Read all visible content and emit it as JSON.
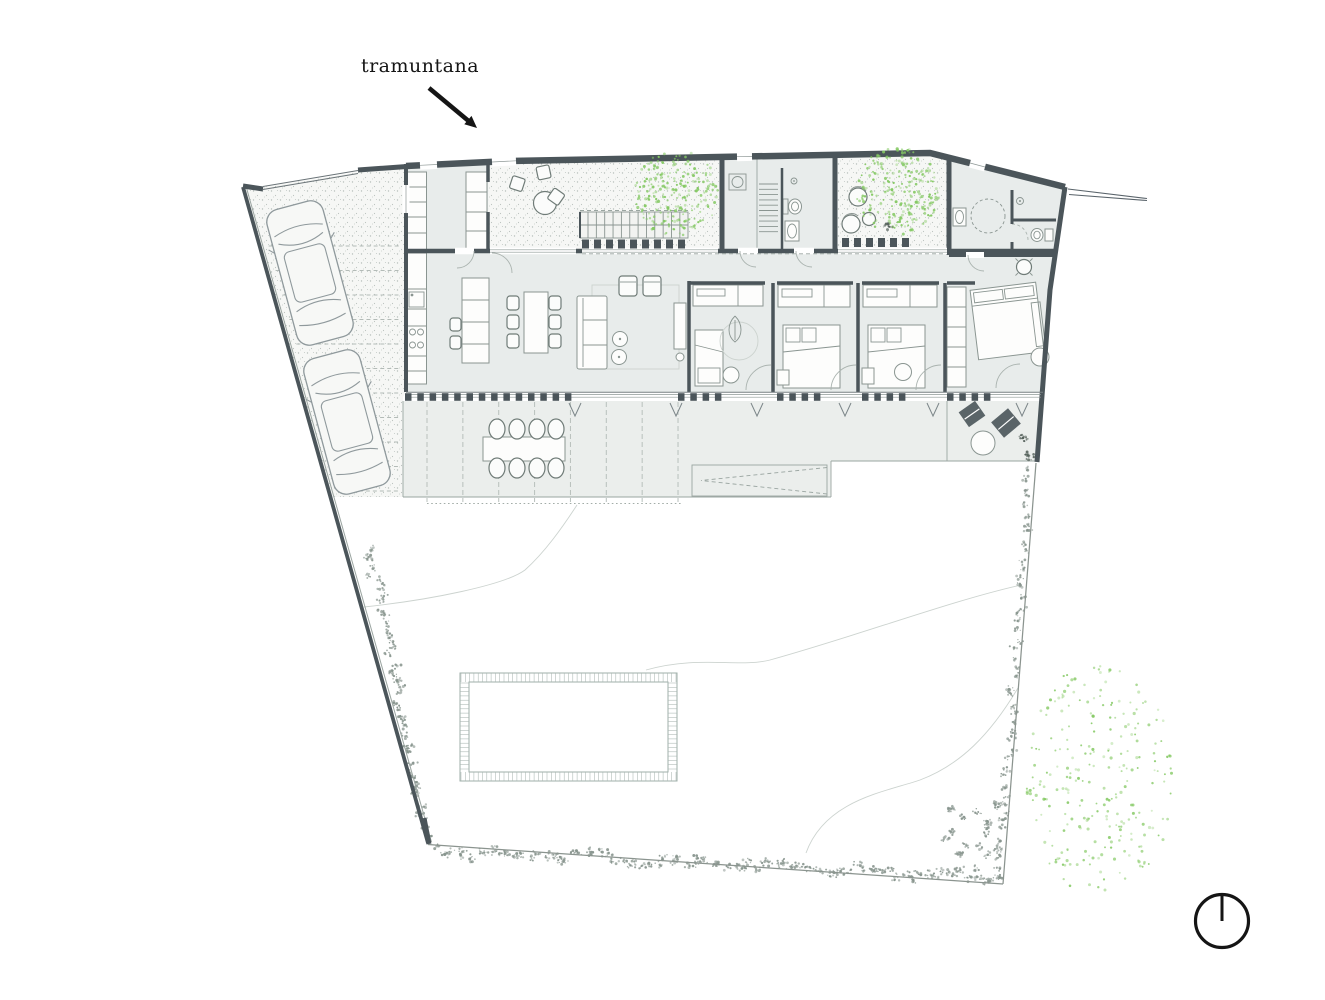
{
  "document": {
    "type": "architectural-site-plan",
    "content": "ground floor plan of a single-storey house with carport, courtyards, pergola terrace, garden and pool"
  },
  "labels": {
    "wind_annotation": "tramuntana"
  },
  "icons": {
    "wind_arrow": "arrow-pointing-southeast",
    "north_indicator": "circle-with-radius-line-to-top"
  },
  "colors": {
    "paper": "#ffffff",
    "ink": "#151515",
    "wall_dark": "#4b555a",
    "room_fill": "#e8eceb",
    "terrace_fill": "#ebeeec",
    "line_faint": "#ccd3cf",
    "vegetation_green": "#85c964",
    "shrub": "#87948d",
    "shrub_dark": "#55615b"
  },
  "plan": {
    "site": "irregular quadrilateral plot, wider at bottom",
    "rooms": [
      "carport",
      "entry-hall",
      "entry-courtyard",
      "stair-courtyard-with-tree",
      "kitchen",
      "dining-area",
      "living-area",
      "laundry-room",
      "bathroom",
      "tree-courtyard",
      "bedroom-1",
      "bedroom-2",
      "bedroom-3",
      "master-bedroom",
      "master-bathroom",
      "pergola-terrace",
      "lounge-terrace",
      "swimming-pool",
      "garden"
    ],
    "counts": {
      "cars": 2,
      "bedrooms": 4,
      "indoor_dining_chairs": 6,
      "outdoor_dining_chairs": 8,
      "courtyard_trees": 2,
      "garden_trees": 1
    },
    "pool_shape": "rectangular with tiled border"
  }
}
